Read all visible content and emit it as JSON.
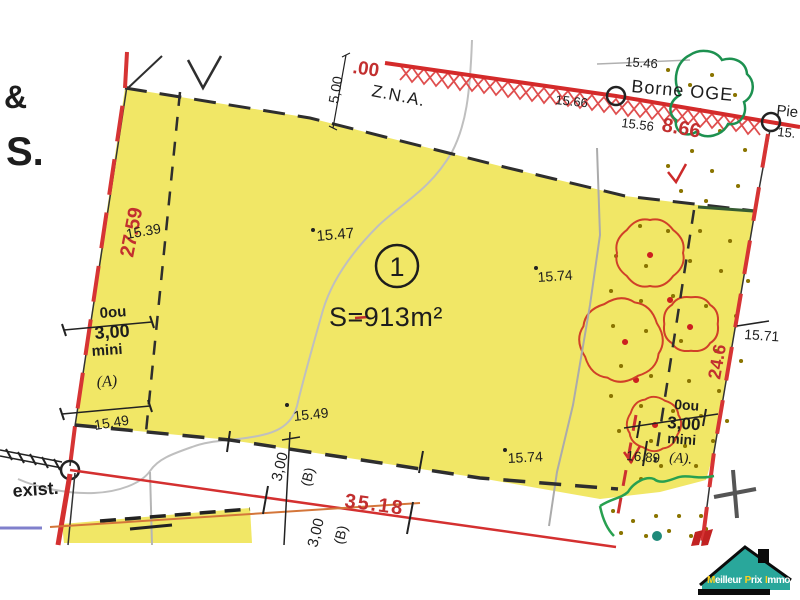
{
  "margin": {
    "amp": "&",
    "s": "S."
  },
  "road": {
    "label_00": ".00",
    "borne_oge": "Borne OGE",
    "d1546": "15.46",
    "d1566": "15.66",
    "d1556": "15.56",
    "d866": "8.66",
    "pie": "Pie",
    "pie_num": "15."
  },
  "zone": {
    "zna": "Z.N.A.",
    "d500": "5,00"
  },
  "parcel": {
    "number": "1",
    "area": "S=913m²",
    "d1547": "15.47",
    "d1574_top": "15.74",
    "d1549_mid": "15.49"
  },
  "left": {
    "d2759": "27.59",
    "d1539": "15.39",
    "block": {
      "l1": "0ou",
      "l2": "3,00",
      "l3": "mini",
      "l4": "(A)"
    },
    "d1549": "15.49"
  },
  "right": {
    "d1571": "15.71",
    "d246": "24.6",
    "block": {
      "l1": "0ou",
      "l2": "3,00",
      "l3": "mini",
      "l4": "(A)."
    },
    "d1689": "16.89",
    "d1574_bottom": "15.74"
  },
  "bottom": {
    "exist": "exist.",
    "d3518": "35.18",
    "d300_1": "3,00",
    "db_1": "(B)",
    "d300_2": "3,00",
    "db_2": "(B)"
  },
  "logo": {
    "m1": "M",
    "m2": "eilleur",
    "p1": "P",
    "p2": "rix",
    "i1": "I",
    "i2": "mmo"
  },
  "colors": {
    "parcel_fill": "#f1e766",
    "boundary_red": "#d63434",
    "dimension_red": "#c22f2f",
    "vegetation_green": "#1d9150",
    "logo_teal": "#29a79b",
    "logo_yellow": "#ffd21f"
  }
}
